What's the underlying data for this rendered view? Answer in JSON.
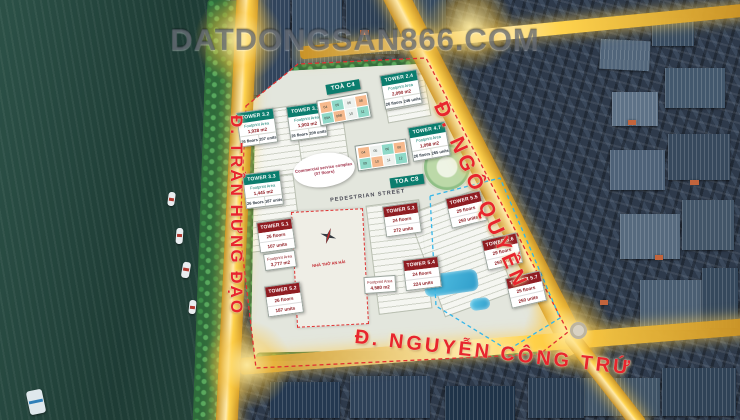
{
  "watermark": "DATDONGSAN866.COM",
  "streets": {
    "left": "Đ. TRẦN HƯNG ĐẠO",
    "right": "Đ. NGÔ QUYỀN",
    "bottom": "Đ. NGUYỄN CÔNG TRỨ",
    "pedestrian": "PEDESTRIAN STREET"
  },
  "site": {
    "church": "NHÀ THỜ AN HẢI",
    "commercial_complex": "Commercial service complex (07 floors)",
    "block_c4": "TOÀ C4",
    "block_c8": "TOA C8"
  },
  "towers": {
    "t32": {
      "name": "TOWER 3.2",
      "area_label": "Footprint Area",
      "area": "1,928 m2",
      "floors": "26 floors",
      "units": "207 units"
    },
    "t31": {
      "name": "TOWER 3.1",
      "area_label": "Footprint Area",
      "area": "1,903 m2",
      "floors": "26 floors",
      "units": "209 units"
    },
    "t24": {
      "name": "TOWER 2.4",
      "area_label": "Footprint Area",
      "area": "2,090 m2",
      "floors": "26 floors",
      "units": "246 units"
    },
    "t47": {
      "name": "TOWER 4.7",
      "area_label": "Footprint Area",
      "area": "1,098 m2",
      "floors": "26 floors",
      "units": "265 units"
    },
    "t33": {
      "name": "TOWER 3.3",
      "area_label": "Footprint Area",
      "area": "1,445 m2",
      "floors": "26 floors",
      "units": "187 units"
    },
    "t51": {
      "name": "TOWER 5.1",
      "floors": "26 floors",
      "units": "107 units",
      "area_label": "Footprint Area",
      "area": "3,777 m2"
    },
    "t52": {
      "name": "TOWER 5.2",
      "floors": "26 floors",
      "units": "187 units"
    },
    "t53": {
      "name": "TOWER 5.3",
      "floors": "24 floors",
      "units": "272 units"
    },
    "t54": {
      "name": "TOWER 5.4",
      "floors": "24 floors",
      "units": "224 units",
      "area_label": "Footprint Area",
      "area": "4,580 m2"
    },
    "t55": {
      "name": "TOWER 5.5",
      "floors": "29 floors",
      "units": "250 units"
    },
    "t56": {
      "name": "TOWER 5.6",
      "floors": "29 floors",
      "units": "250 units"
    },
    "t57": {
      "name": "TOWER 5.7",
      "floors": "25 floors",
      "units": "250 units"
    }
  },
  "unit_grids": {
    "c4": [
      "04",
      "05",
      "06",
      "08",
      "09A",
      "09B",
      "10",
      "11"
    ],
    "c8": [
      "04",
      "05",
      "06",
      "08",
      "09",
      "10",
      "11",
      "12"
    ]
  },
  "colors": {
    "road_gold": "#ffd34d",
    "street_label_red": "#e8262d",
    "teal_header": "#0b7d6e",
    "red_header": "#8f1d22",
    "boundary_red": "#e03131",
    "boundary_blue": "#35b6e8"
  }
}
